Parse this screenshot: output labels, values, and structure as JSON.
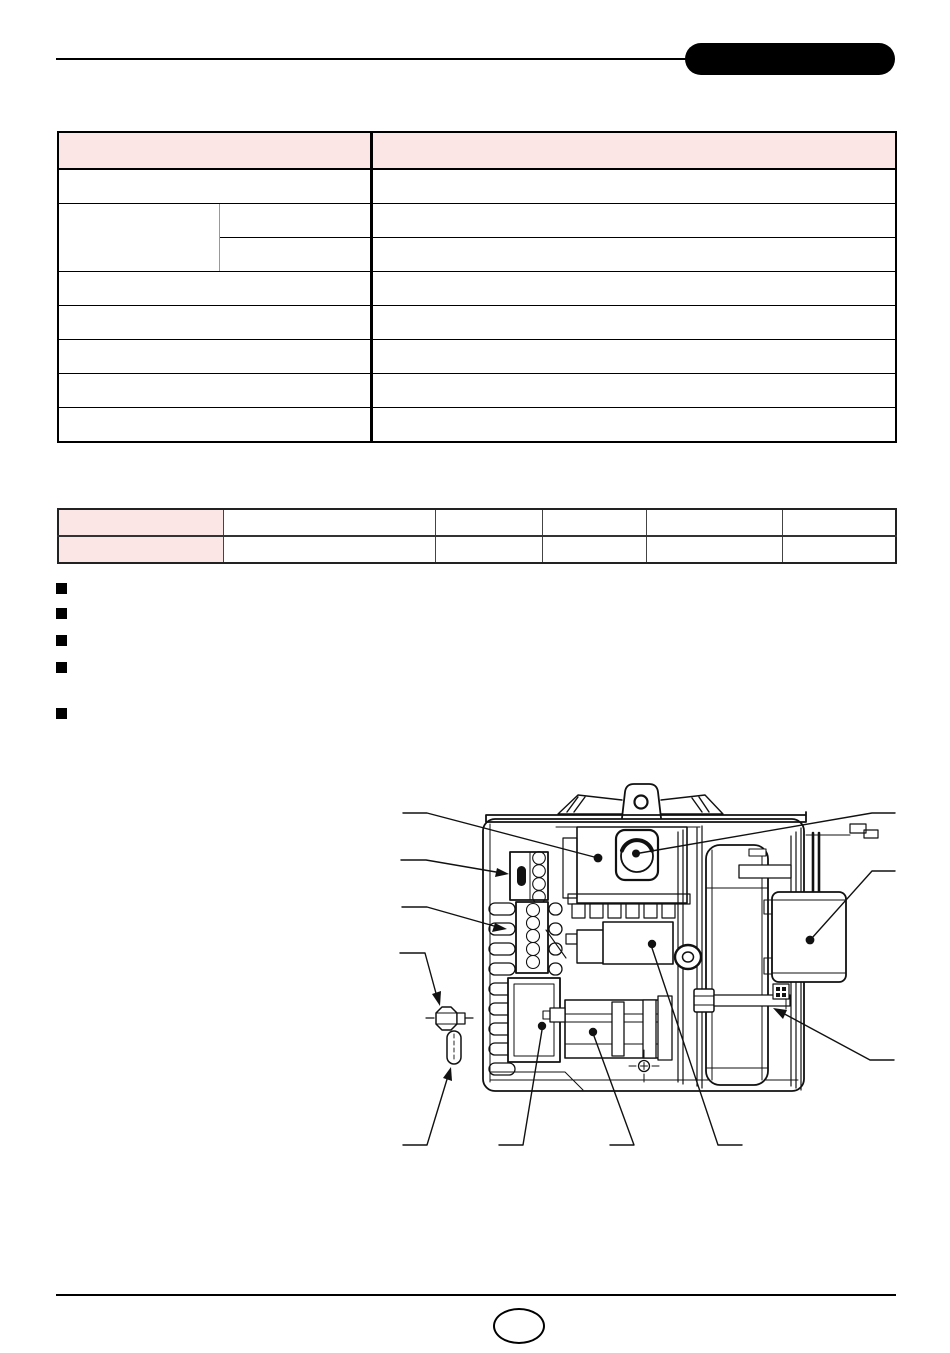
{
  "page": {
    "width": 950,
    "height": 1353,
    "background": "#ffffff"
  },
  "colors": {
    "header_badge": "#000000",
    "table_header_pink": "#fbe5e5",
    "rule_black": "#000000",
    "diagram_stroke": "#111111"
  },
  "header": {
    "badge_label": ""
  },
  "spec_table": {
    "header": [
      "",
      ""
    ],
    "r1": [
      "",
      ""
    ],
    "r2_group": "",
    "r2a": [
      "",
      ""
    ],
    "r2b": [
      "",
      ""
    ],
    "r4": [
      "",
      ""
    ],
    "r5": [
      "",
      ""
    ],
    "r6": [
      "",
      ""
    ],
    "r7": [
      "",
      ""
    ],
    "r8": [
      "",
      ""
    ]
  },
  "model_table": {
    "r1": [
      "",
      "",
      "",
      "",
      "",
      ""
    ],
    "r2": [
      "",
      "",
      "",
      "",
      "",
      ""
    ]
  },
  "bullets": {
    "items": [
      "",
      "",
      "",
      "",
      ""
    ]
  },
  "footer": {
    "page_number": ""
  }
}
